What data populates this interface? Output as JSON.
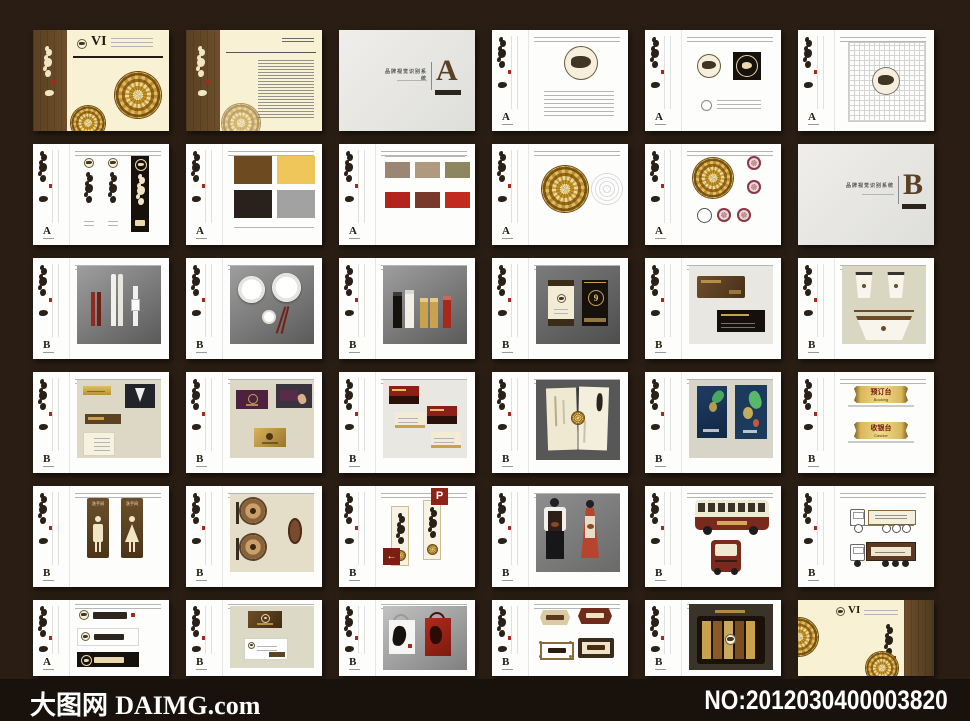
{
  "footer": {
    "site_cn": "大图网",
    "site_en": "DAIMG.com",
    "number": "NO:2012030400003820"
  },
  "letters": {
    "vi": "VI",
    "a": "A",
    "b": "B"
  },
  "dividers": {
    "a": {
      "letter": "A",
      "title": "品牌视觉识别系统"
    },
    "b": {
      "letter": "B",
      "title": "品牌视觉识别系统"
    }
  },
  "signs": {
    "parking": "P",
    "arrow": "←",
    "door_number": "9",
    "restroom": "洗手间",
    "booking_cn": "预订台",
    "booking_en": "Booking",
    "cashier_cn": "收银台",
    "cashier_en": "Cashier"
  },
  "colors": {
    "canvas": "#2a1e14",
    "brand_brown": "#5d4426",
    "gold": "#e9c25c",
    "cream": "#f7f0d2",
    "red": "#a3281e",
    "dark": "#241c12",
    "gray": "#9e9e9e"
  }
}
